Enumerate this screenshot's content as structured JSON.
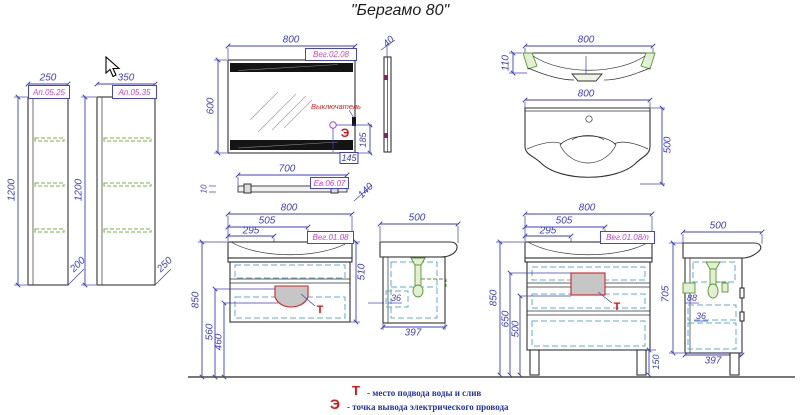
{
  "title": "\"Бергамо 80\"",
  "colors": {
    "dimension": "#3c3cc8",
    "code_label": "#cc3fcc",
    "marker_red": "#e01010",
    "shelf_green": "#7cb342",
    "drawer_cyan": "#62aad2",
    "outline": "#333333"
  },
  "tall_cabinets": {
    "narrow": {
      "width": "250",
      "code": "Ап.05.25",
      "height": "1200",
      "depth": "200"
    },
    "wide": {
      "width": "350",
      "code": "Ап.05.35",
      "height": "1200",
      "depth": "250"
    }
  },
  "mirror": {
    "width": "800",
    "height": "600",
    "depth": "40",
    "code": "Вег.02.08",
    "switch_label": "Выключатель",
    "switch_symbol": "Э",
    "switch_offset_v": "185",
    "switch_offset_h": "145"
  },
  "shelf": {
    "width": "700",
    "thickness": "10",
    "depth": "140",
    "code": "Ев.06.07"
  },
  "basin_front": {
    "width": "800",
    "height": "110"
  },
  "basin_plan": {
    "width": "800",
    "depth": "500"
  },
  "vanity_wall": {
    "width": "800",
    "dim505": "505",
    "dim295": "295",
    "code": "Вег.01.08",
    "height": "510",
    "dim850": "850",
    "dim560": "560",
    "dim460": "460",
    "t": "Т"
  },
  "vanity_wall_side": {
    "depth": "500",
    "dim36": "36",
    "dim397": "397"
  },
  "vanity_floor": {
    "width": "800",
    "dim505": "505",
    "dim295": "295",
    "code": "Вег.01.08/n",
    "dim850": "850",
    "dim650": "650",
    "dim500": "500",
    "dim150": "150",
    "t": "Т"
  },
  "vanity_floor_side": {
    "depth": "500",
    "height": "705",
    "dim88": "88",
    "dim36": "36",
    "dim397": "397"
  },
  "legend": {
    "water_symbol": "Т",
    "water_text": "- место подвода воды и слив",
    "electric_symbol": "Э",
    "electric_text": "- точка вывода электрического провода"
  }
}
